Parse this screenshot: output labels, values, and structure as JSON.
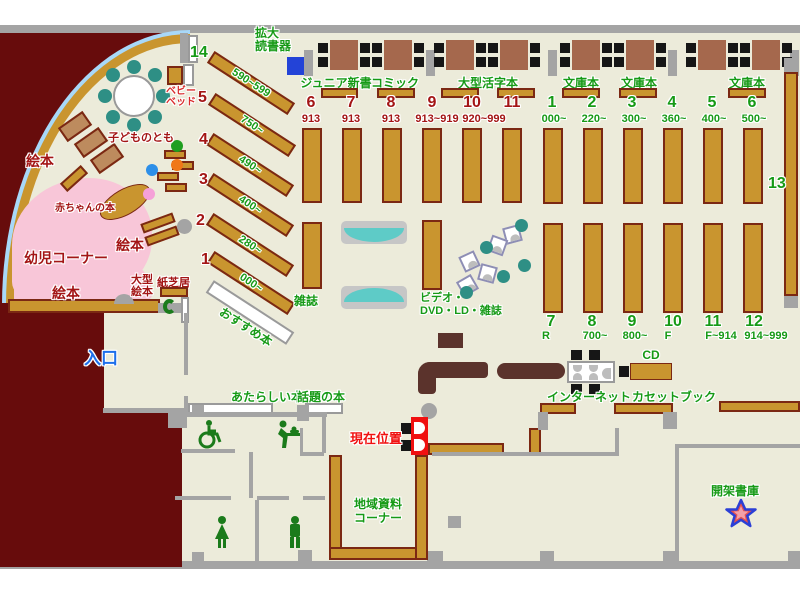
{
  "labels": {
    "entrance": "入口",
    "current_location": "現在位置",
    "magnifier_line1": "拡大",
    "magnifier_line2": "読書器",
    "baby_bed_line1": "ベビー",
    "baby_bed_line2": "ベッド",
    "junior_shinsho": "ジュニア新書",
    "comic": "コミック",
    "large_print": "大型活字本",
    "bunko1": "文庫本",
    "bunko2": "文庫本",
    "bunko3": "文庫本",
    "kodomo_no_tomo": "子どものとも",
    "ehon1": "絵本",
    "ehon2": "絵本",
    "ehon3": "絵本",
    "akachan_books": "赤ちゃんの本",
    "yoji_corner": "幼児コーナー",
    "ogata_ehon_line1": "大型",
    "ogata_ehon_line2": "絵本",
    "kamishibai": "紙芝居",
    "osusume_books": "おすすめ本",
    "zasshi": "雑誌",
    "video_line1": "ビデオ・",
    "video_line2": "DVD・LD・雑誌",
    "atarashii_books": "あたらしい本",
    "wadai_books": "話題の本",
    "chiiki_line1": "地域資料",
    "chiiki_line2": "コーナー",
    "internet": "インターネット",
    "cd": "CD",
    "cassette_book": "カセットブック",
    "kaika_shoko": "開架書庫",
    "shelf13": "13"
  },
  "diagonal_shelves": [
    {
      "num": "14",
      "range": "590~599"
    },
    {
      "num": "5",
      "range": "750~"
    },
    {
      "num": "4",
      "range": "490~"
    },
    {
      "num": "3",
      "range": "400~"
    },
    {
      "num": "2",
      "range": "280~"
    },
    {
      "num": "1",
      "range": "000~"
    }
  ],
  "middle_top_shelves": [
    {
      "num": "6",
      "range": "913"
    },
    {
      "num": "7",
      "range": "913"
    },
    {
      "num": "8",
      "range": "913"
    },
    {
      "num": "9",
      "range": "913~919"
    },
    {
      "num": "10",
      "range": "920~999"
    },
    {
      "num": "11",
      "range": ""
    }
  ],
  "right_top_shelves": [
    {
      "num": "1",
      "range": "000~"
    },
    {
      "num": "2",
      "range": "220~"
    },
    {
      "num": "3",
      "range": "300~"
    },
    {
      "num": "4",
      "range": "360~"
    },
    {
      "num": "5",
      "range": "400~"
    },
    {
      "num": "6",
      "range": "500~"
    }
  ],
  "right_bottom_shelves": [
    {
      "num": "7",
      "range": "R"
    },
    {
      "num": "8",
      "range": "700~"
    },
    {
      "num": "9",
      "range": "800~"
    },
    {
      "num": "10",
      "range": "F"
    },
    {
      "num": "11",
      "range": "F~914"
    },
    {
      "num": "12",
      "range": "914~999"
    }
  ],
  "colors": {
    "floor": "#ECEBDA",
    "outside": "#670C0C",
    "shelf": "#C9952F",
    "green_text": "#169A16",
    "dark_red_text": "#A31515",
    "red_text": "#F01010",
    "blue_text": "#1D6FEB",
    "teal": "#2E8F85",
    "pink_zone": "#F8C6D8"
  }
}
